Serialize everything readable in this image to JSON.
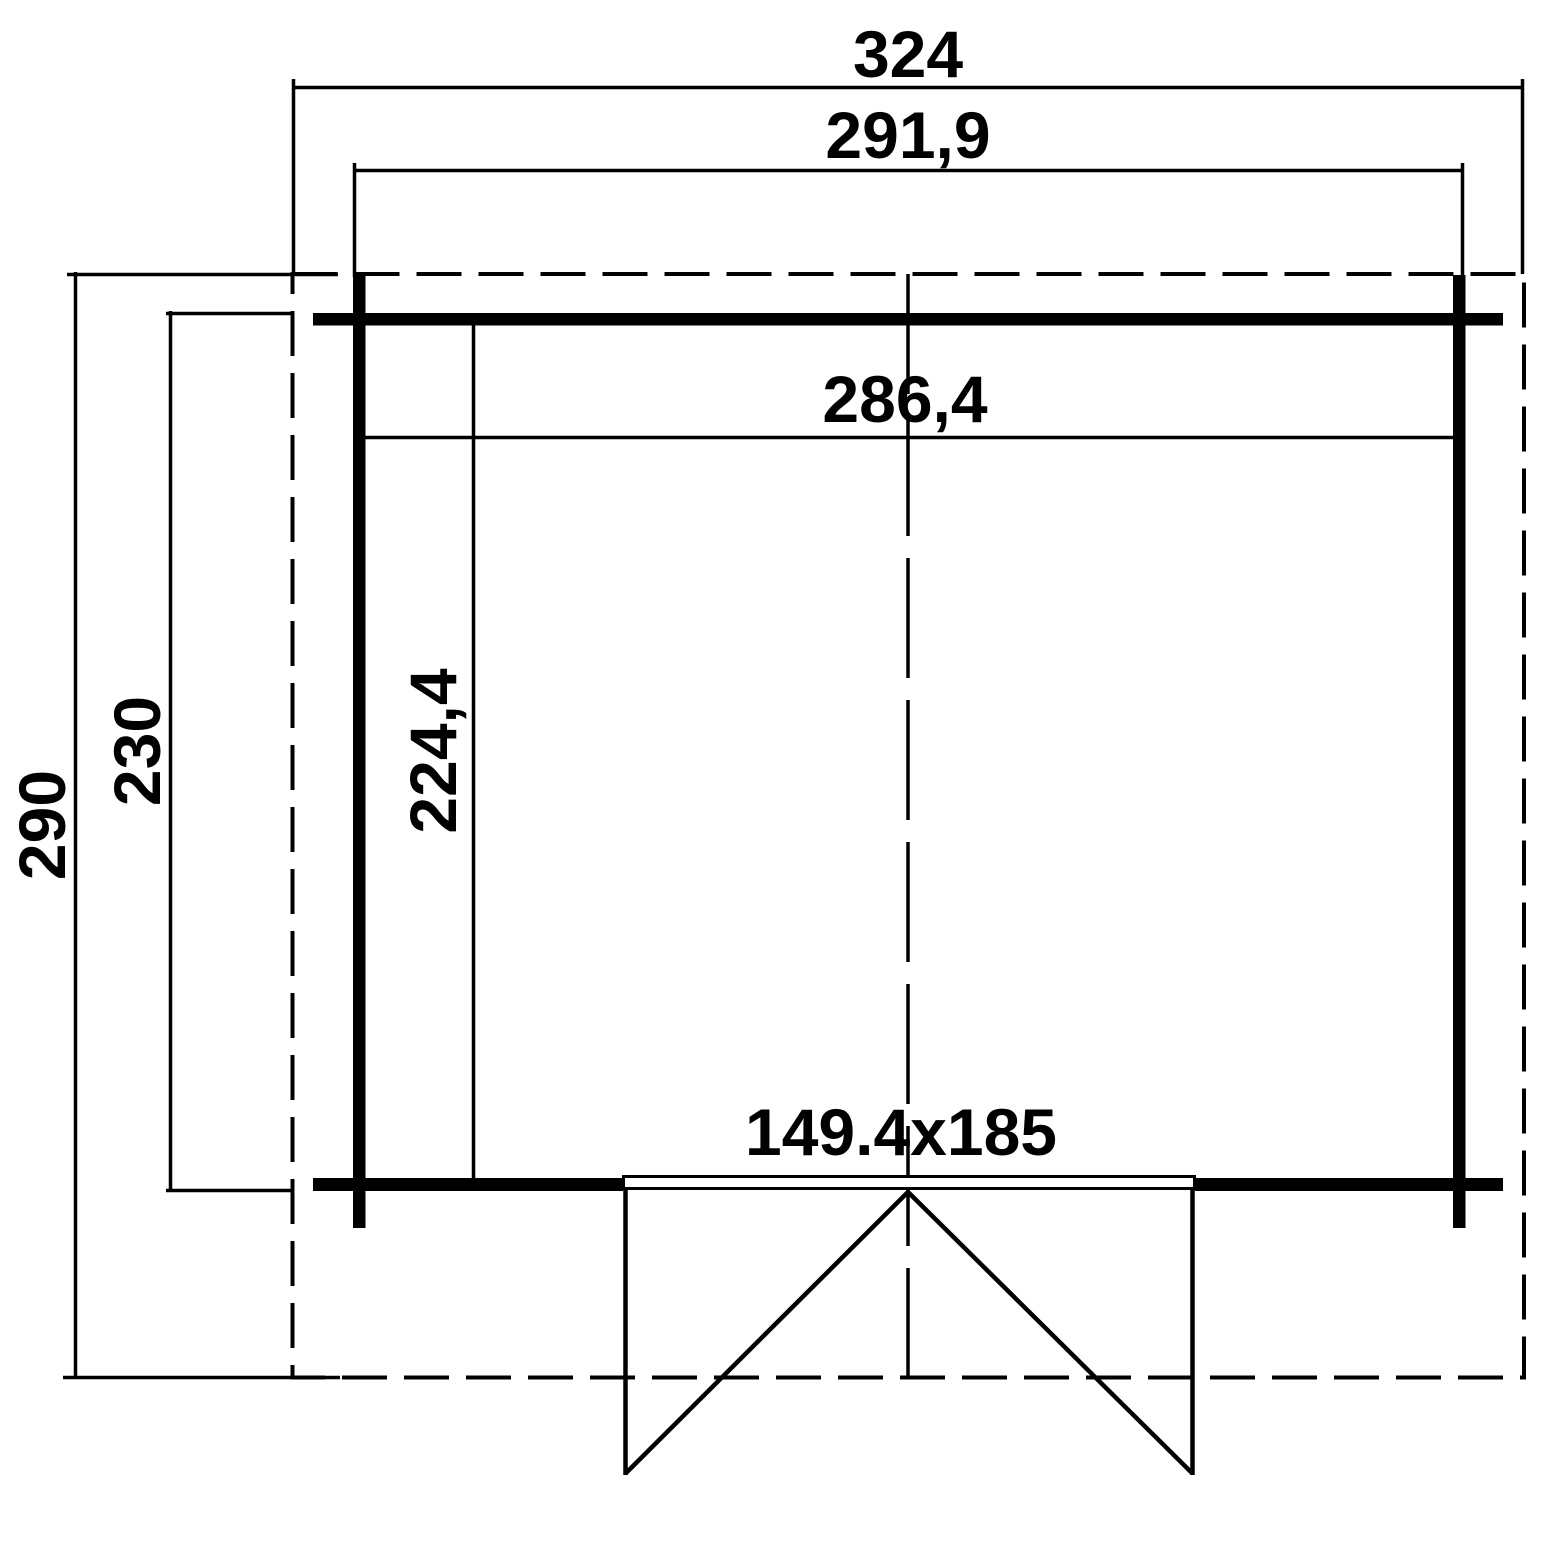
{
  "drawing": {
    "type": "floor-plan",
    "background_color": "#ffffff",
    "line_color": "#000000",
    "dimensions": {
      "overall_width": "324",
      "wall_outer_width": "291,9",
      "inner_width": "286,4",
      "overall_depth": "290",
      "wall_outer_depth": "230",
      "inner_depth": "224,4",
      "door_size": "149.4x185"
    }
  }
}
